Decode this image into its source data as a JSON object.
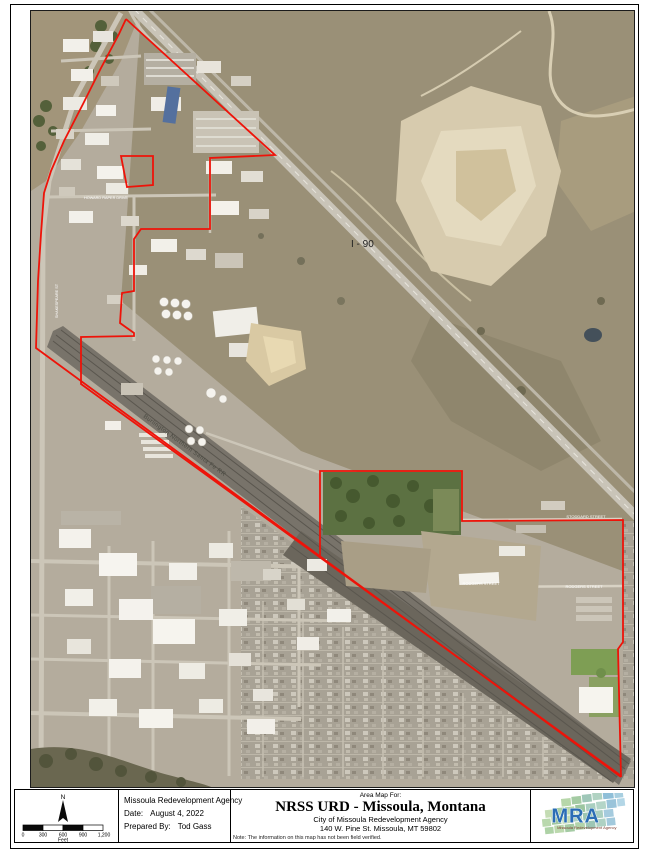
{
  "colors": {
    "boundary_red": "#ee1309",
    "highway_gray": "#c9c4b8",
    "rail_dark": "#78736a",
    "logo_blue": "#2a6db5",
    "logo_green": "#a9cfa6"
  },
  "map": {
    "labels": {
      "i90": "I - 90",
      "railroad": "Burlington Northern Santa Fe RR",
      "street_stoddard": "STODDARD STREET",
      "street_rodgers_w": "RODGERS STREET",
      "street_rodgers_e": "RODGERS STREET",
      "street_shakespeare": "SHAKESPEARE ST",
      "street_howard": "HOWARD RAPER DRIVE"
    }
  },
  "titleblock": {
    "north_label": "N",
    "scale_ticks": [
      "0",
      "300",
      "600",
      "900",
      "1,200"
    ],
    "scale_unit": "Feet",
    "agency_name": "Missoula Redevelopment Agency",
    "date_label": "Date:",
    "date_value": "August 4, 2022",
    "prepared_label": "Prepared By:",
    "prepared_value": "Tod Gass",
    "area_map_for": "Area Map For:",
    "map_title": "NRSS URD - Missoula, Montana",
    "org_line1": "City of Missoula Redevelopment Agency",
    "org_line2": "140 W. Pine St.   Missoula, MT 59802",
    "note": "Note:  The information on this map has not been field verified.",
    "logo_text": "MRA",
    "logo_tagline": "Missoula Redevelopment Agency"
  }
}
